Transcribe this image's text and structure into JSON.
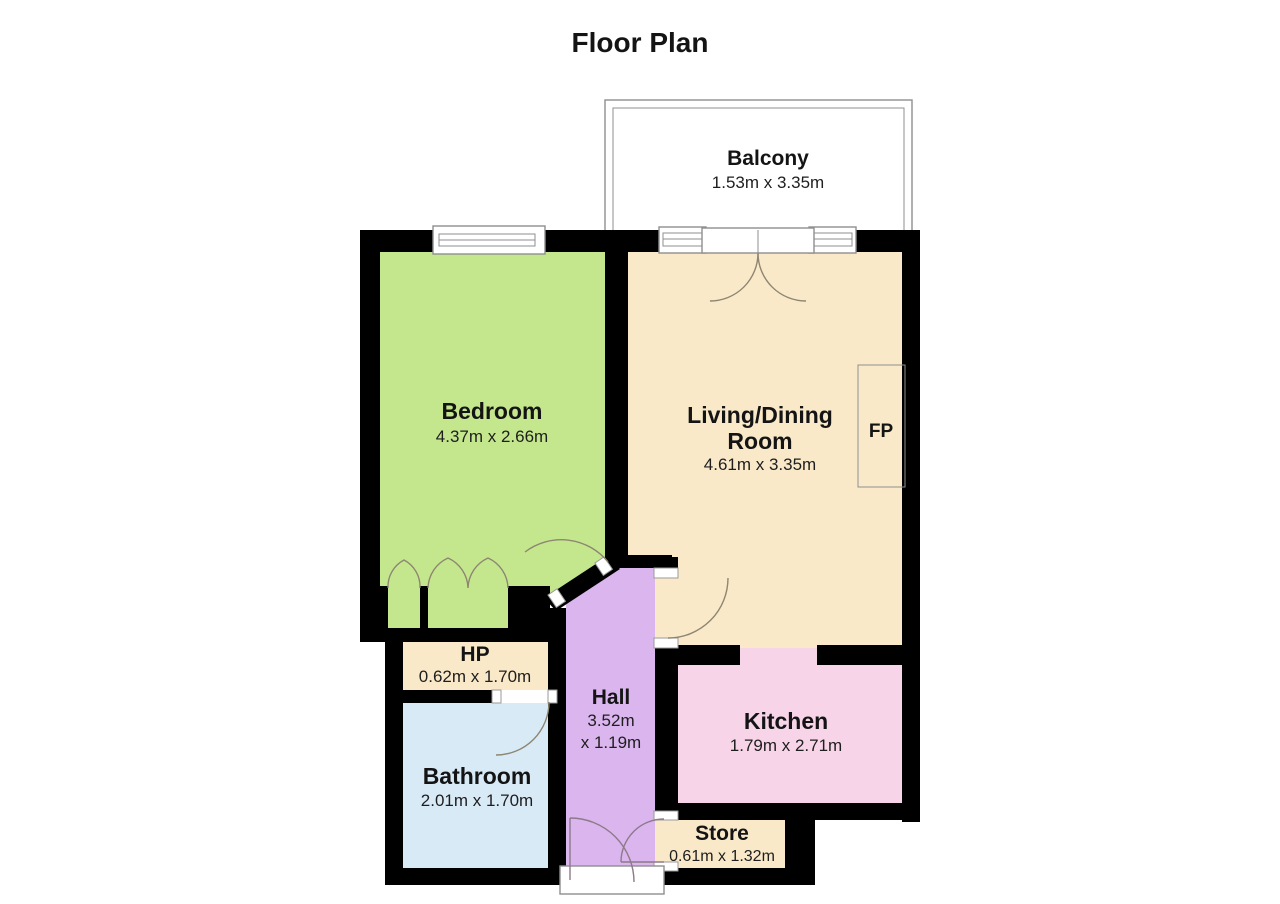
{
  "title": "Floor Plan",
  "colors": {
    "wall": "#000000",
    "bedroom": "#c4e78d",
    "living_room": "#f9e9c9",
    "hall": "#dab5ee",
    "kitchen": "#f8d4e9",
    "bathroom": "#d9eaf7",
    "cream": "#f9e9c9",
    "white": "#ffffff"
  },
  "rooms": {
    "balcony": {
      "name": "Balcony",
      "dims": "1.53m x 3.35m"
    },
    "bedroom": {
      "name": "Bedroom",
      "dims": "4.37m x 2.66m"
    },
    "living": {
      "name_line1": "Living/Dining",
      "name_line2": "Room",
      "dims": "4.61m x 3.35m"
    },
    "fireplace": {
      "name": "FP"
    },
    "hp": {
      "name": "HP",
      "dims": "0.62m x 1.70m"
    },
    "hall": {
      "name": "Hall",
      "dims_line1": "3.52m",
      "dims_line2": "x 1.19m"
    },
    "kitchen": {
      "name": "Kitchen",
      "dims": "1.79m x 2.71m"
    },
    "bathroom": {
      "name": "Bathroom",
      "dims": "2.01m x 1.70m"
    },
    "store": {
      "name": "Store",
      "dims": "0.61m x 1.32m"
    }
  }
}
